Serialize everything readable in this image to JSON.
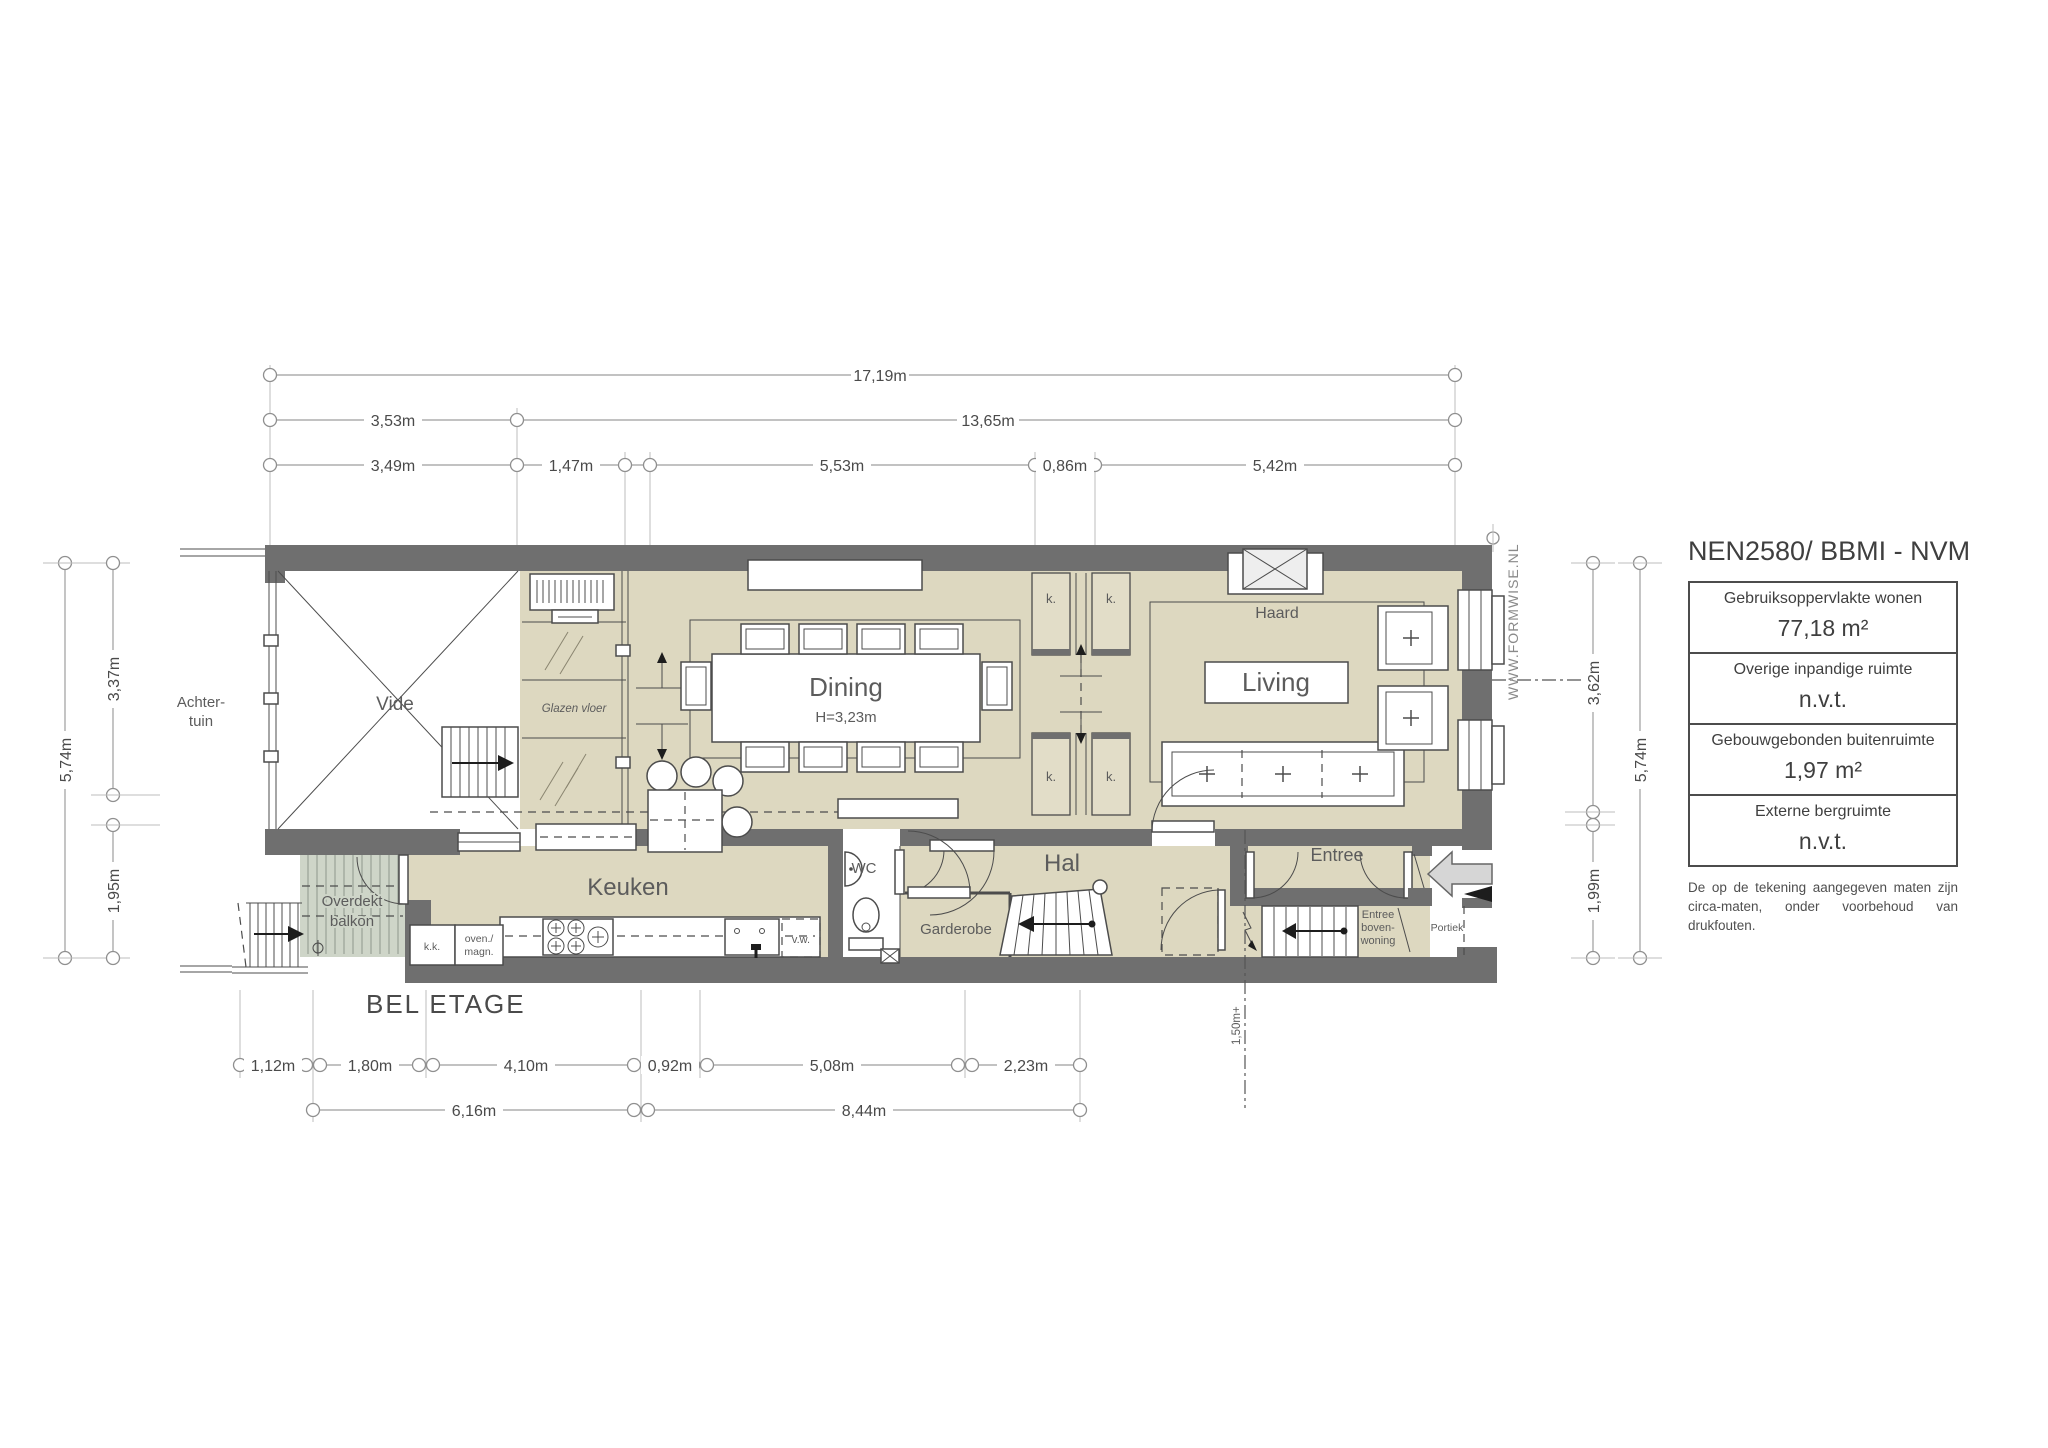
{
  "title": "BEL ETAGE",
  "watermark": "WWW.FORMWISE.NL",
  "colors": {
    "wall": "#6f6f6f",
    "floor": "#ddd8c0",
    "balcony": "#ced5c8",
    "line": "#4c4c4c",
    "dim_line": "#9e9e9e"
  },
  "rooms": {
    "achtertuin_l1": "Achter-",
    "achtertuin_l2": "tuin",
    "vide": "Vide",
    "glazen_vloer": "Glazen vloer",
    "dining": "Dining",
    "dining_h": "H=3,23m",
    "haard": "Haard",
    "living": "Living",
    "keuken": "Keuken",
    "wc": "WC",
    "hal": "Hal",
    "garderobe": "Garderobe",
    "entree": "Entree",
    "balkon_l1": "Overdekt",
    "balkon_l2": "balkon",
    "bovenwoning_l1": "Entree",
    "bovenwoning_l2": "boven-",
    "bovenwoning_l3": "woning",
    "portiek": "Portiek",
    "k": "k.",
    "kk": "k.k.",
    "oven_l1": "oven./",
    "oven_l2": "magn.",
    "vw": "v.w.",
    "level": "1,50m+"
  },
  "dimensions": {
    "top_total": "17,19m",
    "top_a": "3,53m",
    "top_b": "13,65m",
    "top_c1": "3,49m",
    "top_c2": "1,47m",
    "top_c3": "5,53m",
    "top_c4": "0,86m",
    "top_c5": "5,42m",
    "left_outer": "5,74m",
    "left_a": "3,37m",
    "left_b": "1,95m",
    "right_a": "3,62m",
    "right_outer": "5,74m",
    "right_b": "1,99m",
    "bot_a": "1,12m",
    "bot_b": "1,80m",
    "bot_c": "4,10m",
    "bot_d": "0,92m",
    "bot_e": "5,08m",
    "bot_f": "2,23m",
    "bot_g": "6,16m",
    "bot_h": "8,44m"
  },
  "legend": {
    "title": "NEN2580/ BBMI - NVM",
    "rows": [
      {
        "label": "Gebruiksoppervlakte wonen",
        "value": "77,18 m²"
      },
      {
        "label": "Overige inpandige ruimte",
        "value": "n.v.t."
      },
      {
        "label": "Gebouwgebonden buitenruimte",
        "value": "1,97 m²"
      },
      {
        "label": "Externe bergruimte",
        "value": "n.v.t."
      }
    ],
    "disclaimer": "De op de tekening aangegeven maten zijn circa-maten, onder voorbehoud van drukfouten."
  }
}
